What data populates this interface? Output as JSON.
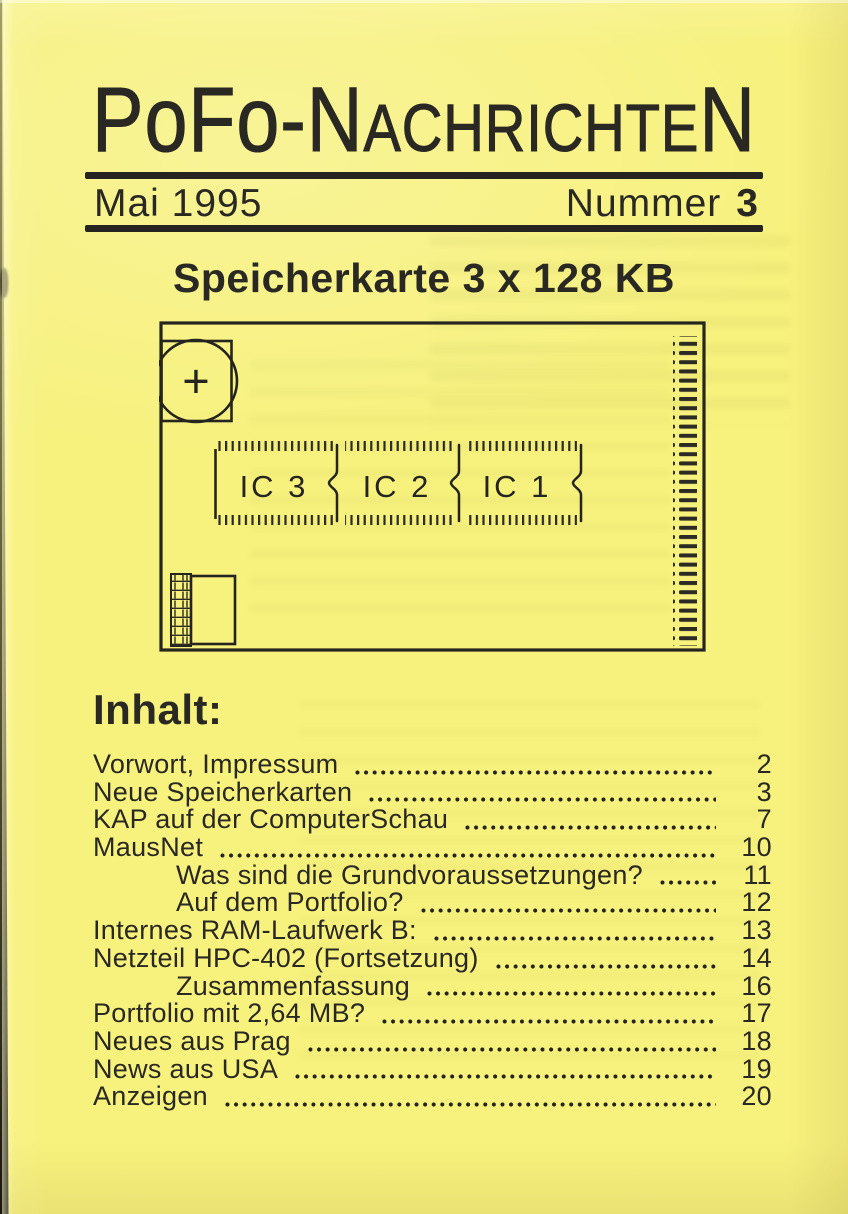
{
  "colors": {
    "paper": "#f7f17d",
    "ink": "#2a2822"
  },
  "masthead": {
    "title": "PoFo-Nachrichten",
    "title_segments": [
      {
        "t": "P",
        "s": "lg"
      },
      {
        "t": "o",
        "s": "lo"
      },
      {
        "t": "F",
        "s": "lg"
      },
      {
        "t": "o",
        "s": "lo"
      },
      {
        "t": "-",
        "s": "lg"
      },
      {
        "t": "N",
        "s": "lg"
      },
      {
        "t": "ACHRICHTE",
        "s": "sm"
      },
      {
        "t": "N",
        "s": "lg"
      }
    ],
    "issue_date": "Mai 1995",
    "issue_label": "Nummer",
    "issue_number": "3"
  },
  "article_heading": "Speicherkarte 3 x 128 KB",
  "diagram": {
    "description": "memory-card-schematic",
    "battery_symbol": "+",
    "chip_labels": [
      "IC 3",
      "IC 2",
      "IC 1"
    ]
  },
  "toc": {
    "heading": "Inhalt:",
    "items": [
      {
        "title": "Vorwort, Impressum",
        "page": "2",
        "indent": false
      },
      {
        "title": "Neue Speicherkarten",
        "page": "3",
        "indent": false
      },
      {
        "title": "KAP auf der ComputerSchau",
        "page": "7",
        "indent": false
      },
      {
        "title": "MausNet",
        "page": "10",
        "indent": false
      },
      {
        "title": "Was sind die Grundvoraussetzungen?",
        "page": "11",
        "indent": true
      },
      {
        "title": "Auf dem Portfolio?",
        "page": "12",
        "indent": true
      },
      {
        "title": "Internes RAM-Laufwerk B:",
        "page": "13",
        "indent": false
      },
      {
        "title": "Netzteil HPC-402 (Fortsetzung)",
        "page": "14",
        "indent": false
      },
      {
        "title": "Zusammenfassung",
        "page": "16",
        "indent": true
      },
      {
        "title": "Portfolio mit 2,64 MB?",
        "page": "17",
        "indent": false
      },
      {
        "title": "Neues aus Prag",
        "page": "18",
        "indent": false
      },
      {
        "title": "News aus USA",
        "page": "19",
        "indent": false
      },
      {
        "title": "Anzeigen",
        "page": "20",
        "indent": false
      }
    ]
  }
}
